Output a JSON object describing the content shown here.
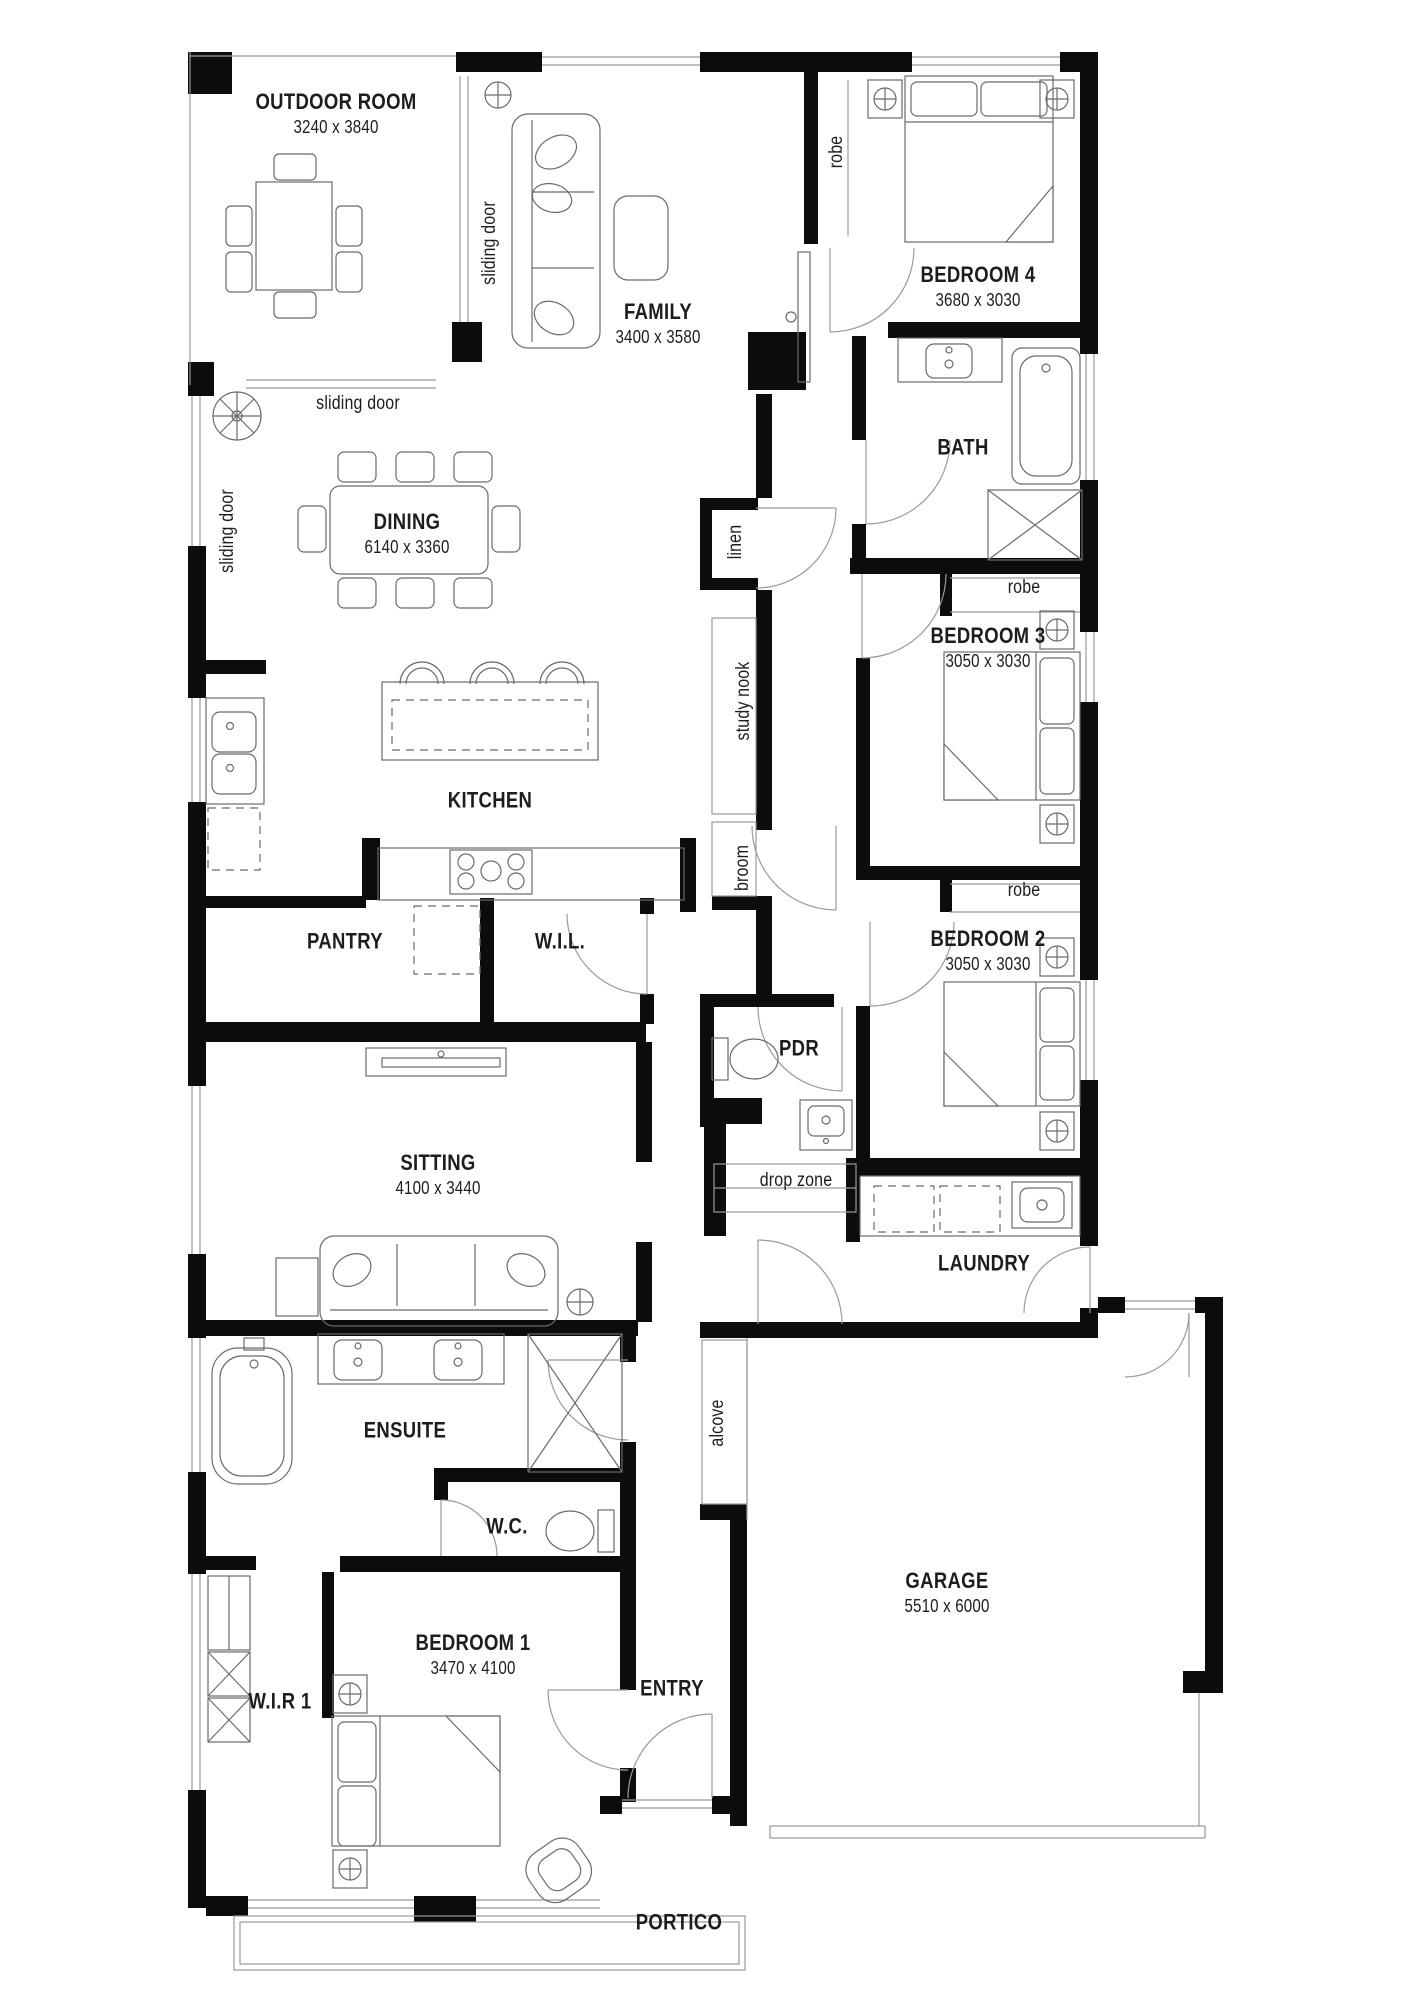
{
  "colors": {
    "wall": "#0c0c0c",
    "line": "#6b6b6b",
    "thin": "#9a9a9a",
    "ink": "#1d1d1d",
    "bg": "#ffffff"
  },
  "labels": [
    {
      "text": "OUTDOOR ROOM",
      "dims": "3240 x 3840"
    },
    {
      "text": "FAMILY",
      "dims": "3400 x 3580"
    },
    {
      "text": "BEDROOM 4",
      "dims": "3680 x 3030"
    },
    {
      "text": "BATH"
    },
    {
      "text": "DINING",
      "dims": "6140 x 3360"
    },
    {
      "text": "BEDROOM 3",
      "dims": "3050 x 3030"
    },
    {
      "text": "KITCHEN"
    },
    {
      "text": "BEDROOM 2",
      "dims": "3050 x 3030"
    },
    {
      "text": "PANTRY"
    },
    {
      "text": "W.I.L."
    },
    {
      "text": "PDR"
    },
    {
      "text": "SITTING",
      "dims": "4100 x 3440"
    },
    {
      "text": "LAUNDRY"
    },
    {
      "text": "ENSUITE"
    },
    {
      "text": "W.C."
    },
    {
      "text": "GARAGE",
      "dims": "5510 x 6000"
    },
    {
      "text": "BEDROOM 1",
      "dims": "3470 x 4100"
    },
    {
      "text": "W.I.R 1"
    },
    {
      "text": "ENTRY"
    },
    {
      "text": "PORTICO"
    }
  ],
  "small": [
    {
      "text": "sliding door"
    },
    {
      "text": "sliding door"
    },
    {
      "text": "sliding door"
    },
    {
      "text": "robe"
    },
    {
      "text": "linen"
    },
    {
      "text": "robe"
    },
    {
      "text": "study nook"
    },
    {
      "text": "broom"
    },
    {
      "text": "robe"
    },
    {
      "text": "drop zone"
    },
    {
      "text": "alcove"
    }
  ]
}
